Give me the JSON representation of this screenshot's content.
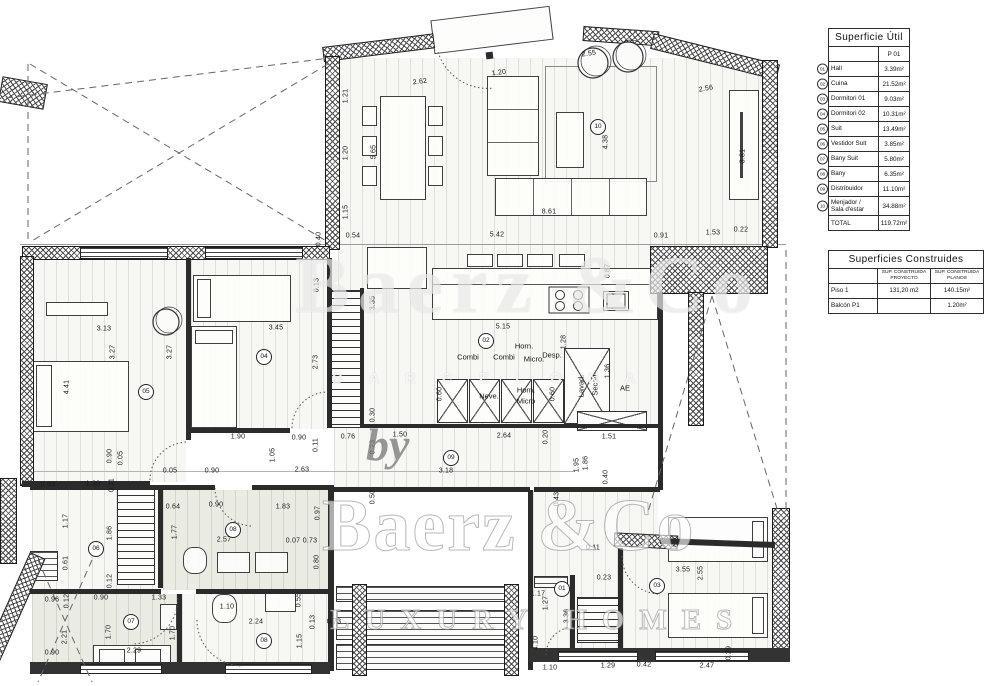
{
  "tables": {
    "superficie_util": {
      "title": "Superficie Útil",
      "col_header": "P 01",
      "rows": [
        {
          "id": "01",
          "name": "Hall",
          "value": "3.39m²"
        },
        {
          "id": "02",
          "name": "Cuina",
          "value": "21.52m²"
        },
        {
          "id": "03",
          "name": "Dormitori 01",
          "value": "9.03m²"
        },
        {
          "id": "04",
          "name": "Dormitori 02",
          "value": "10.31m²"
        },
        {
          "id": "05",
          "name": "Suit",
          "value": "13.49m²"
        },
        {
          "id": "06",
          "name": "Vestidor Suit",
          "value": "3.85m²"
        },
        {
          "id": "07",
          "name": "Bany Suit",
          "value": "5.80m²"
        },
        {
          "id": "08",
          "name": "Bany",
          "value": "6.35m²"
        },
        {
          "id": "09",
          "name": "Distribuidor",
          "value": "11.10m²"
        },
        {
          "id": "10",
          "name": "Menjador /\nSala d'estar",
          "value": "34.88m²"
        }
      ],
      "total_label": "TOTAL",
      "total_value": "119.72m²"
    },
    "superficies_construides": {
      "title": "Superficies Construides",
      "col1": "Sup. CONSTRUIDA PROYECTO",
      "col2": "Sup. CONSTRUIDA PLANOS",
      "rows": [
        {
          "name": "Piso 1",
          "proyecto": "131,20 m2",
          "planos": "140.15m²"
        },
        {
          "name": "Balcón P1",
          "proyecto": "",
          "planos": "1.20m²"
        }
      ]
    }
  },
  "watermark": {
    "top": "Baerz &Co",
    "band": "B A R C E L O N A",
    "prefix": "by",
    "brand": "Baerz &Co",
    "tagline": "LUXURY HOMES"
  },
  "rooms": [
    {
      "n": "01",
      "x": 562,
      "y": 589
    },
    {
      "n": "02",
      "x": 486,
      "y": 341
    },
    {
      "n": "03",
      "x": 657,
      "y": 586
    },
    {
      "n": "04",
      "x": 264,
      "y": 357
    },
    {
      "n": "05",
      "x": 146,
      "y": 392
    },
    {
      "n": "06",
      "x": 96,
      "y": 549
    },
    {
      "n": "07",
      "x": 131,
      "y": 622
    },
    {
      "n": "08",
      "x": 233,
      "y": 530
    },
    {
      "n": "08",
      "x": 264,
      "y": 641
    },
    {
      "n": "09",
      "x": 451,
      "y": 458
    },
    {
      "n": "10",
      "x": 598,
      "y": 127
    }
  ],
  "kitchen_labels": [
    {
      "t": "Combi",
      "x": 468,
      "y": 357
    },
    {
      "t": "Combi",
      "x": 504,
      "y": 357
    },
    {
      "t": "Micro.",
      "x": 534,
      "y": 359
    },
    {
      "t": "Horn.",
      "x": 524,
      "y": 346
    },
    {
      "t": "Desp.",
      "x": 552,
      "y": 355
    },
    {
      "t": "Neve.",
      "x": 489,
      "y": 396
    },
    {
      "t": "Horn.",
      "x": 526,
      "y": 390
    },
    {
      "t": "Micro",
      "x": 526,
      "y": 401
    },
    {
      "t": "Lavad.",
      "x": 581,
      "y": 386,
      "v": 1
    },
    {
      "t": "Secad.",
      "x": 595,
      "y": 384,
      "v": 1
    },
    {
      "t": "AE",
      "x": 625,
      "y": 388
    }
  ],
  "dims": [
    {
      "t": "2.62",
      "x": 420,
      "y": 82,
      "r": -7
    },
    {
      "t": "1.20",
      "x": 499,
      "y": 73,
      "r": -7
    },
    {
      "t": "2.55",
      "x": 589,
      "y": 54,
      "r": -8
    },
    {
      "t": "2.56",
      "x": 706,
      "y": 89,
      "r": -10
    },
    {
      "t": "1.21",
      "x": 346,
      "y": 96,
      "v": 1
    },
    {
      "t": "1.20",
      "x": 346,
      "y": 153,
      "v": 1
    },
    {
      "t": "1.15",
      "x": 346,
      "y": 212,
      "v": 1
    },
    {
      "t": "0.54",
      "x": 353,
      "y": 236
    },
    {
      "t": "5.65",
      "x": 374,
      "y": 152,
      "v": 1
    },
    {
      "t": "4.38",
      "x": 606,
      "y": 142,
      "v": 1
    },
    {
      "t": "3.81",
      "x": 743,
      "y": 156,
      "v": 1
    },
    {
      "t": "8.61",
      "x": 549,
      "y": 212
    },
    {
      "t": "5.42",
      "x": 497,
      "y": 235
    },
    {
      "t": "0.91",
      "x": 661,
      "y": 236
    },
    {
      "t": "1.53",
      "x": 713,
      "y": 233
    },
    {
      "t": "0.22",
      "x": 741,
      "y": 230
    },
    {
      "t": "0.40",
      "x": 319,
      "y": 239,
      "v": 1
    },
    {
      "t": "0.87",
      "x": 608,
      "y": 271,
      "v": 1
    },
    {
      "t": "5.15",
      "x": 503,
      "y": 327
    },
    {
      "t": "1.28",
      "x": 564,
      "y": 342,
      "v": 1
    },
    {
      "t": "1.36",
      "x": 608,
      "y": 371,
      "v": 1
    },
    {
      "t": "0.60",
      "x": 440,
      "y": 394,
      "v": 1
    },
    {
      "t": "0.60",
      "x": 553,
      "y": 394,
      "v": 1
    },
    {
      "t": "1.51",
      "x": 609,
      "y": 437
    },
    {
      "t": "1.86",
      "x": 586,
      "y": 463,
      "v": 1
    },
    {
      "t": "0.40",
      "x": 606,
      "y": 477,
      "v": 1
    },
    {
      "t": "3.13",
      "x": 104,
      "y": 329
    },
    {
      "t": "3.27",
      "x": 113,
      "y": 352,
      "v": 1
    },
    {
      "t": "3.27",
      "x": 170,
      "y": 352,
      "v": 1
    },
    {
      "t": "4.41",
      "x": 67,
      "y": 387,
      "v": 1
    },
    {
      "t": "3.45",
      "x": 276,
      "y": 328
    },
    {
      "t": "2.73",
      "x": 316,
      "y": 362,
      "v": 1
    },
    {
      "t": "3.35",
      "x": 373,
      "y": 303,
      "v": 1
    },
    {
      "t": "0.13",
      "x": 317,
      "y": 285,
      "v": 1
    },
    {
      "t": "0.11",
      "x": 316,
      "y": 445,
      "v": 1
    },
    {
      "t": "1.90",
      "x": 238,
      "y": 437
    },
    {
      "t": "0.90",
      "x": 299,
      "y": 438
    },
    {
      "t": "0.76",
      "x": 348,
      "y": 437
    },
    {
      "t": "0.23",
      "x": 373,
      "y": 447,
      "v": 1
    },
    {
      "t": "0.90",
      "x": 110,
      "y": 456,
      "v": 1
    },
    {
      "t": "0.05",
      "x": 121,
      "y": 458,
      "v": 1
    },
    {
      "t": "0.05",
      "x": 170,
      "y": 471
    },
    {
      "t": "0.90",
      "x": 212,
      "y": 471
    },
    {
      "t": "1.05",
      "x": 273,
      "y": 455,
      "v": 1
    },
    {
      "t": "1.30",
      "x": 93,
      "y": 484
    },
    {
      "t": "0.63",
      "x": 48,
      "y": 485
    },
    {
      "t": "0.11",
      "x": 112,
      "y": 485,
      "v": 1
    },
    {
      "t": "0.30",
      "x": 373,
      "y": 415,
      "v": 1
    },
    {
      "t": "1.50",
      "x": 400,
      "y": 435
    },
    {
      "t": "2.64",
      "x": 504,
      "y": 436
    },
    {
      "t": "0.20",
      "x": 546,
      "y": 437,
      "v": 1
    },
    {
      "t": "2.63",
      "x": 302,
      "y": 470
    },
    {
      "t": "3.18",
      "x": 446,
      "y": 471
    },
    {
      "t": "1.95",
      "x": 577,
      "y": 465,
      "v": 1
    },
    {
      "t": "0.50",
      "x": 373,
      "y": 497,
      "v": 1
    },
    {
      "t": "0.43",
      "x": 557,
      "y": 499,
      "v": 1
    },
    {
      "t": "1.83",
      "x": 283,
      "y": 507
    },
    {
      "t": "0.97",
      "x": 318,
      "y": 513,
      "v": 1
    },
    {
      "t": "1.17",
      "x": 66,
      "y": 521,
      "v": 1
    },
    {
      "t": "1.86",
      "x": 110,
      "y": 533,
      "v": 1
    },
    {
      "t": "0.61",
      "x": 66,
      "y": 563,
      "v": 1
    },
    {
      "t": "0.12",
      "x": 110,
      "y": 581,
      "v": 1
    },
    {
      "t": "0.64",
      "x": 173,
      "y": 507
    },
    {
      "t": "0.90",
      "x": 216,
      "y": 505
    },
    {
      "t": "1.77",
      "x": 175,
      "y": 532,
      "v": 1
    },
    {
      "t": "2.57",
      "x": 224,
      "y": 540
    },
    {
      "t": "0.07",
      "x": 293,
      "y": 541
    },
    {
      "t": "0.73",
      "x": 310,
      "y": 541
    },
    {
      "t": "0.80",
      "x": 317,
      "y": 562,
      "v": 1
    },
    {
      "t": "0.96",
      "x": 52,
      "y": 600
    },
    {
      "t": "0.12",
      "x": 67,
      "y": 601,
      "v": 1
    },
    {
      "t": "0.90",
      "x": 101,
      "y": 598
    },
    {
      "t": "1.33",
      "x": 159,
      "y": 598
    },
    {
      "t": "1.70",
      "x": 109,
      "y": 632,
      "v": 1
    },
    {
      "t": "1.70",
      "x": 173,
      "y": 633,
      "v": 1
    },
    {
      "t": "2.21",
      "x": 65,
      "y": 637,
      "v": 1
    },
    {
      "t": "2.29",
      "x": 134,
      "y": 651
    },
    {
      "t": "0.90",
      "x": 52,
      "y": 653
    },
    {
      "t": "1.10",
      "x": 227,
      "y": 607
    },
    {
      "t": "0.55",
      "x": 299,
      "y": 600,
      "v": 1
    },
    {
      "t": "2.24",
      "x": 256,
      "y": 622
    },
    {
      "t": "0.13",
      "x": 313,
      "y": 622,
      "v": 1
    },
    {
      "t": "0.73",
      "x": 334,
      "y": 622
    },
    {
      "t": "1.15",
      "x": 300,
      "y": 641,
      "v": 1
    },
    {
      "t": "1.17",
      "x": 538,
      "y": 594
    },
    {
      "t": "1.27",
      "x": 546,
      "y": 603,
      "v": 1
    },
    {
      "t": "3.36",
      "x": 567,
      "y": 616,
      "v": 1
    },
    {
      "t": "4.10",
      "x": 536,
      "y": 643,
      "v": 1
    },
    {
      "t": "0.11",
      "x": 593,
      "y": 548
    },
    {
      "t": "0.23",
      "x": 604,
      "y": 578
    },
    {
      "t": "3.55",
      "x": 683,
      "y": 570
    },
    {
      "t": "2.55",
      "x": 701,
      "y": 573,
      "v": 1
    },
    {
      "t": "0.29",
      "x": 729,
      "y": 653,
      "v": 1
    },
    {
      "t": "1.10",
      "x": 550,
      "y": 668
    },
    {
      "t": "0.42",
      "x": 644,
      "y": 665
    },
    {
      "t": "1.29",
      "x": 608,
      "y": 666
    },
    {
      "t": "2.47",
      "x": 707,
      "y": 666
    }
  ]
}
